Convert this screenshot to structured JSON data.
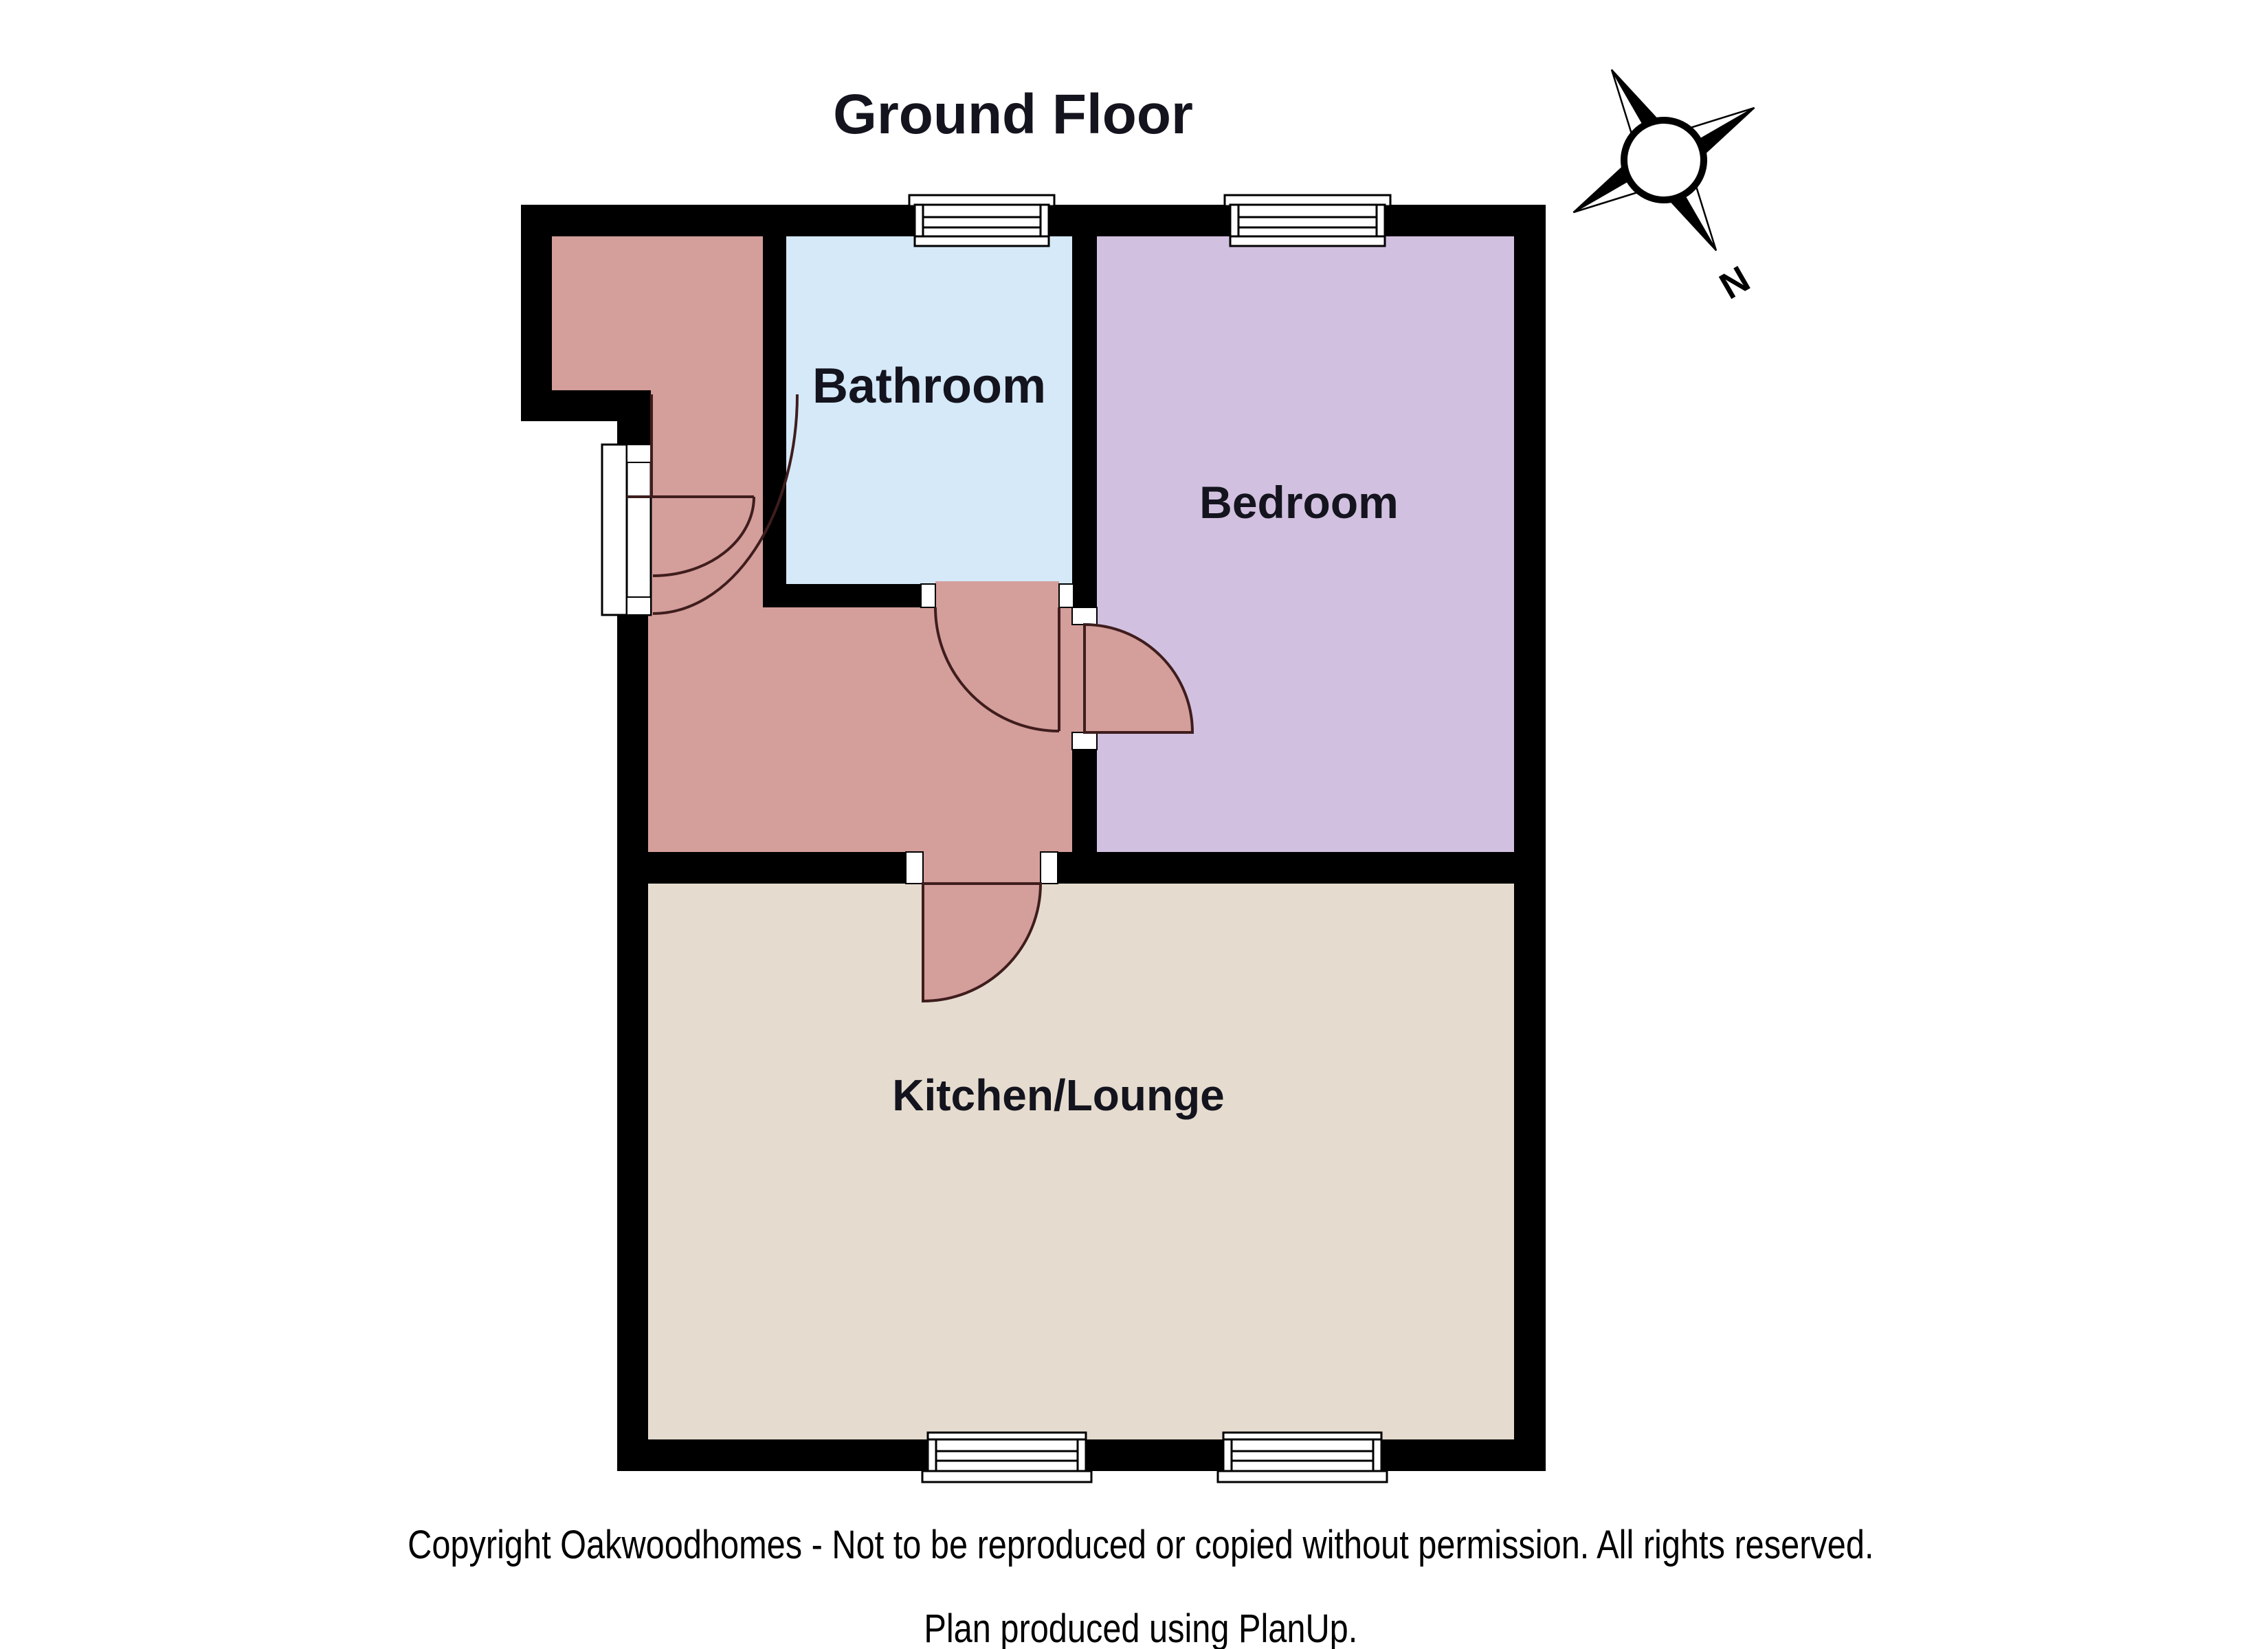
{
  "header": {
    "title": "Ground Floor"
  },
  "compass": {
    "label": "N"
  },
  "rooms": {
    "bathroom": {
      "label": "Bathroom",
      "color": "#d5e9f8"
    },
    "bedroom": {
      "label": "Bedroom",
      "color": "#d2c0e0"
    },
    "kitchen_lounge": {
      "label": "Kitchen/Lounge",
      "color": "#e5dccf"
    },
    "hallway": {
      "color": "#d49e9b"
    }
  },
  "colors": {
    "walls": "#000000",
    "door_arc": "#3f1d1d",
    "label_text": "#14141e"
  },
  "footer": {
    "copyright": "Copyright Oakwoodhomes - Not to be reproduced or copied without permission. All rights reserved.",
    "credit": "Plan produced using PlanUp."
  }
}
